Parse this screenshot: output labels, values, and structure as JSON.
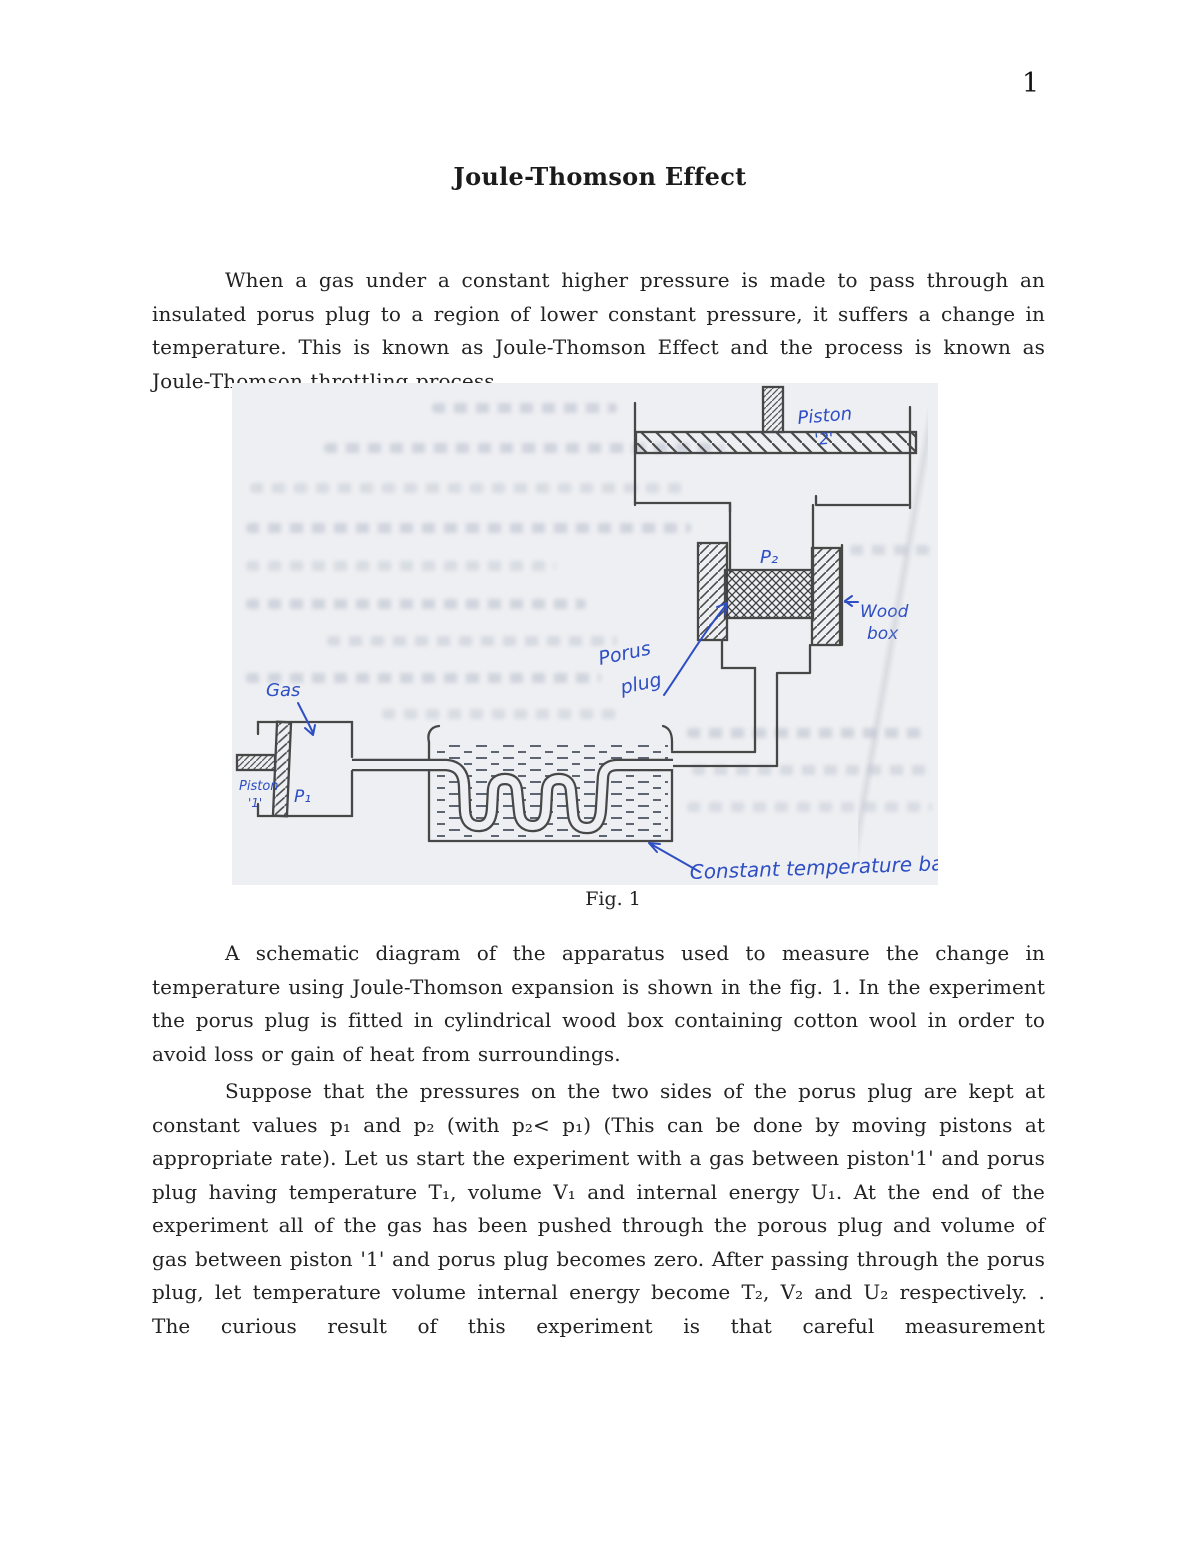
{
  "page": {
    "number": "1"
  },
  "title": "Joule-Thomson Effect",
  "paragraphs": {
    "intro": "When a gas under a constant higher pressure is made to pass through an insulated porus plug to a region of lower constant pressure, it suffers a change in temperature. This is known as Joule-Thomson Effect and the process is known as Joule-Thomson throttling process.",
    "apparatus": "A schematic diagram of the apparatus used to measure the change in temperature using Joule-Thomson expansion is shown in the fig. 1. In the experiment the porus plug is fitted in cylindrical wood box containing cotton wool in order to avoid loss or gain of heat from surroundings.",
    "experiment": "Suppose that the pressures on the two sides of the porus plug are kept at constant values p₁ and p₂ (with p₂< p₁) (This can be done by moving pistons at appropriate rate). Let us start the experiment with a gas between piston'1' and porus plug having temperature T₁, volume V₁ and internal energy U₁. At the end of the experiment all of the gas has been pushed through the porous plug and volume of gas between piston '1' and porus plug becomes zero. After passing through the porus plug, let temperature volume internal energy become T₂, V₂ and U₂ respectively. . The curious result of this experiment is that careful measurement"
  },
  "figure": {
    "caption": "Fig. 1",
    "labels": {
      "piston2_l1": "Piston",
      "piston2_l2": "'2'",
      "p2": "P₂",
      "woodbox_l1": "Wood",
      "woodbox_l2": "box",
      "porus_l1": "Porus",
      "porus_l2": "plug",
      "gas": "Gas",
      "piston1_l1": "Piston",
      "piston1_l2": "'1'",
      "p1": "P₁",
      "bath": "Constant temperature bath"
    },
    "ink_color": "#2e4ec4",
    "pencil_color": "#474747",
    "paper_color": "#edeff2"
  }
}
